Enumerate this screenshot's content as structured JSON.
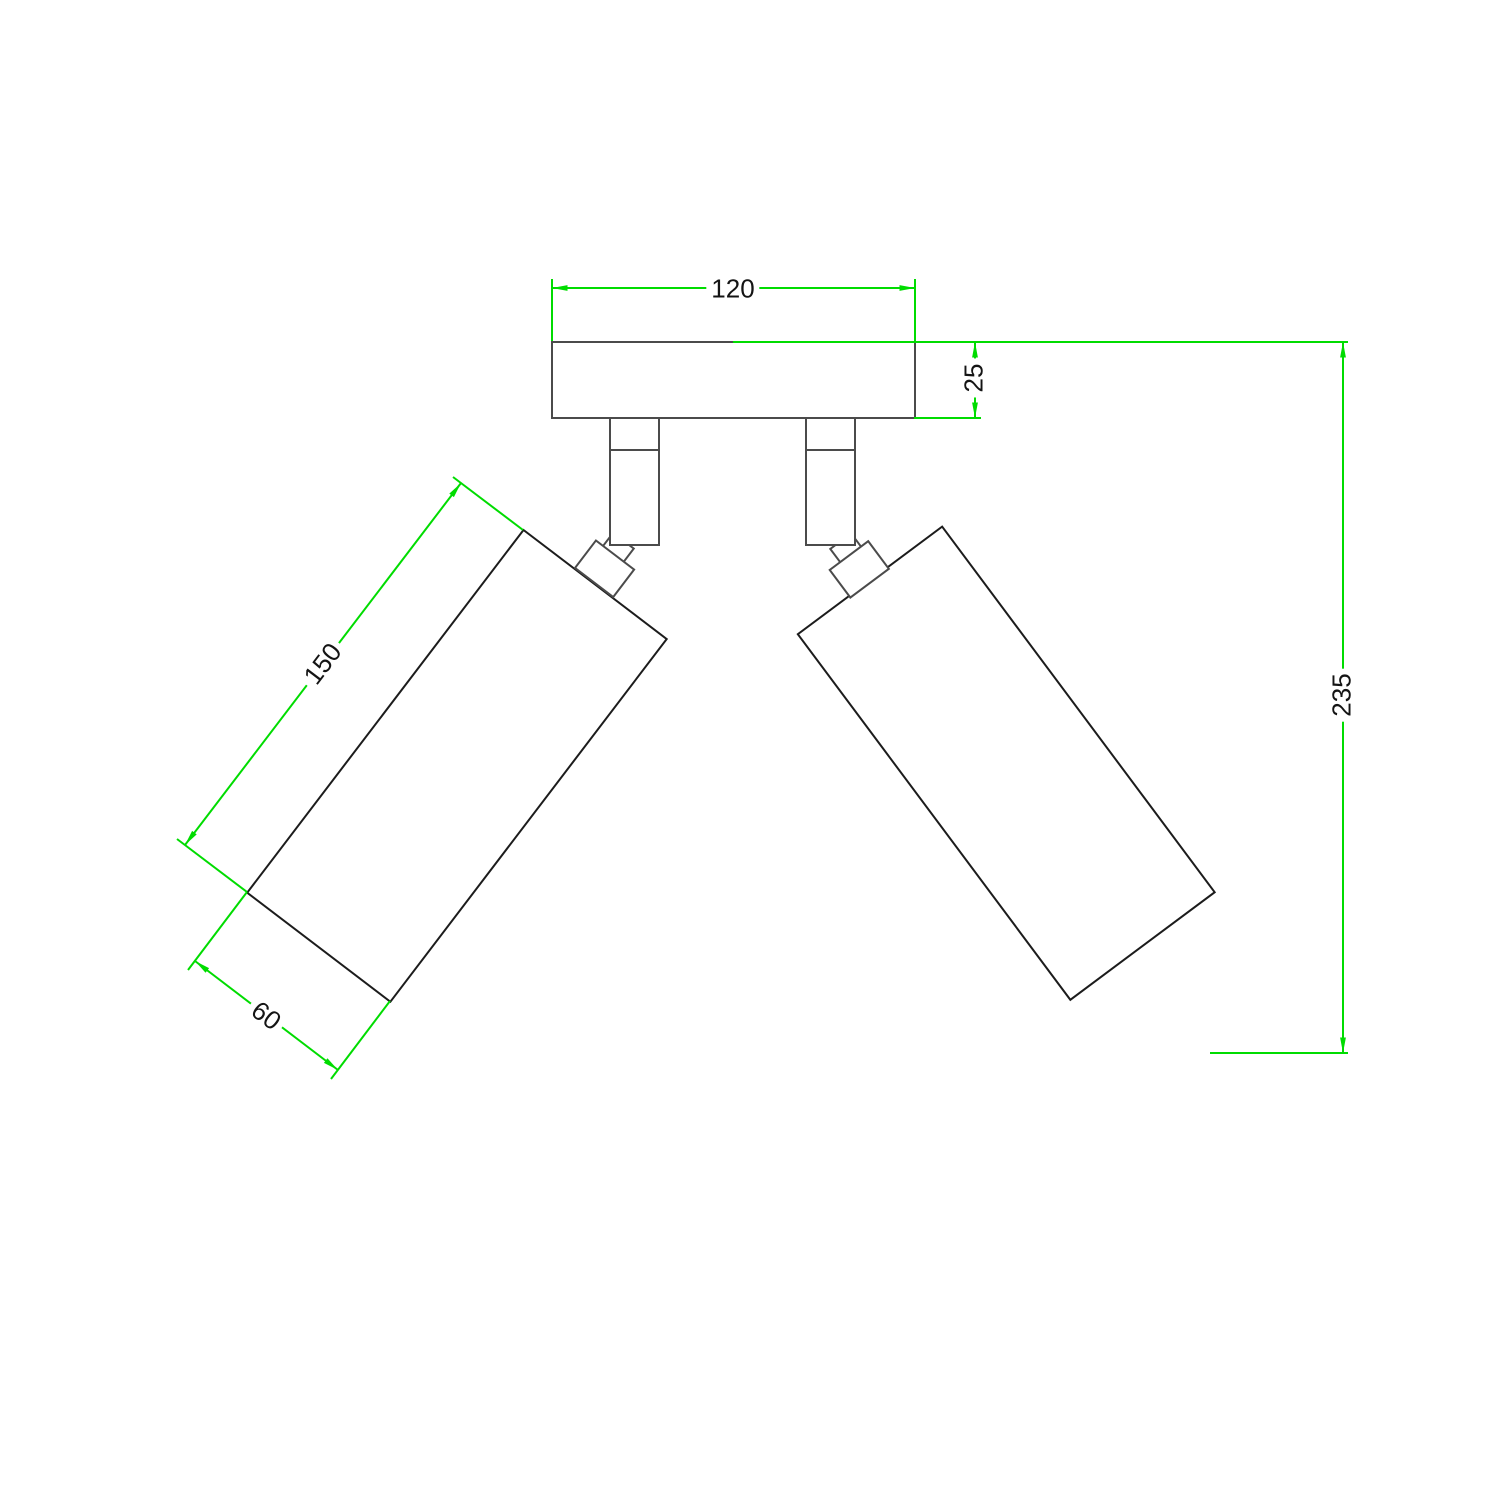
{
  "drawing": {
    "kind": "technical-dimension-drawing",
    "subject": "double adjustable spotlight ceiling lamp - front view"
  },
  "colors": {
    "dimension": "#00dc00",
    "outline_dark": "#1c1c1c",
    "outline_gray": "#4b4b4b",
    "label_text": "#141414",
    "background": "#ffffff"
  },
  "dimensions": {
    "plate_width": "120",
    "plate_thickness": "25",
    "spotlight_length": "150",
    "spotlight_diameter": "60",
    "overall_height": "235"
  }
}
